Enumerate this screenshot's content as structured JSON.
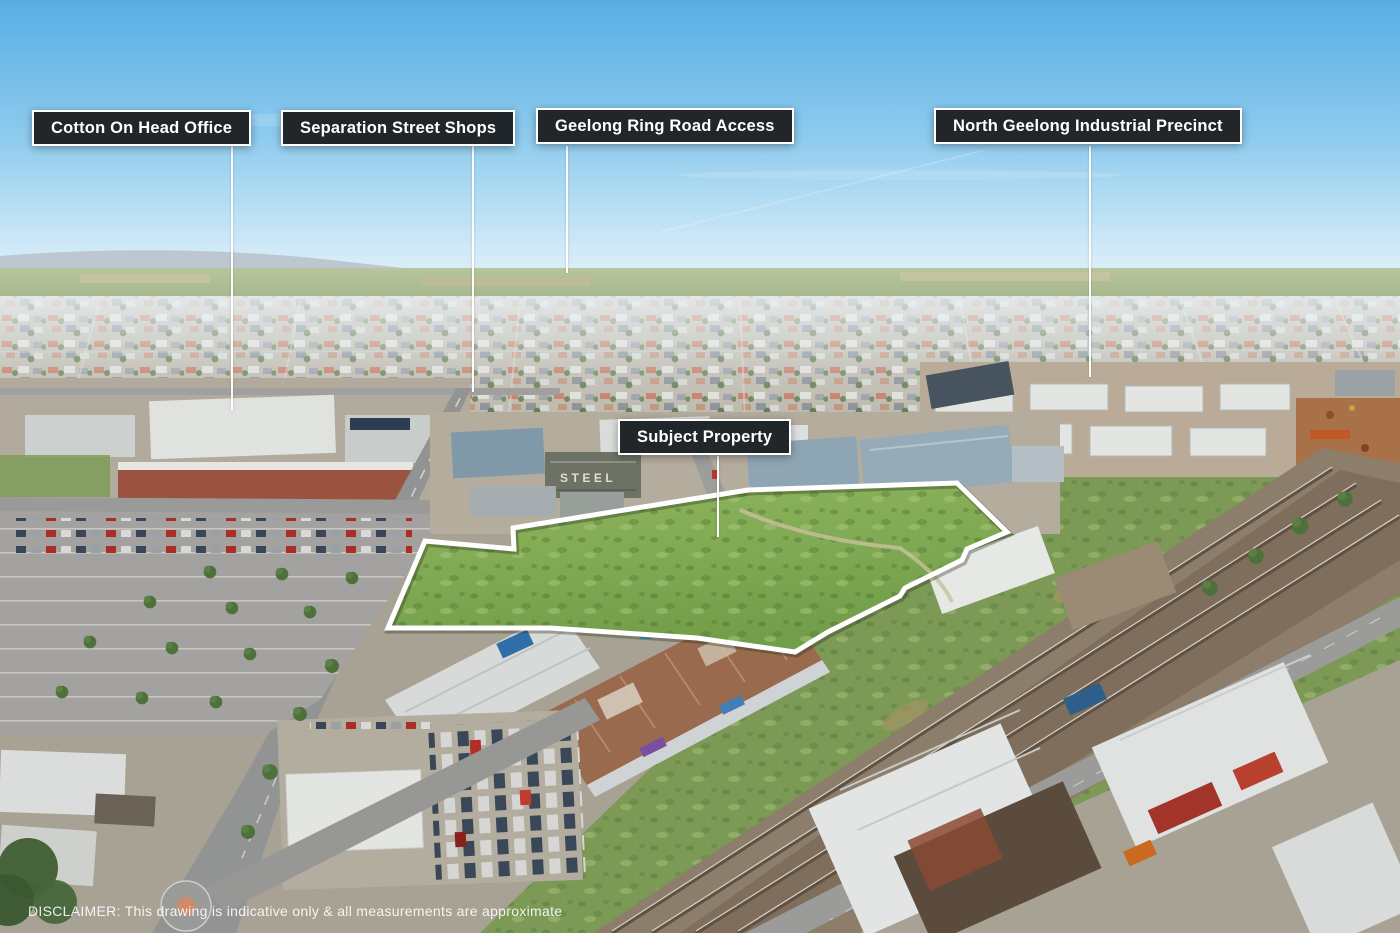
{
  "scene": {
    "description": "Aerial drone photograph of a vacant industrial land parcel outlined in white beside a railway corridor, North Geelong",
    "colors": {
      "sky_top": "#57aee4",
      "sky_horizon": "#eef6fb",
      "field_green": "#7fa952",
      "boundary": "#ffffff",
      "label_background": "#21262a",
      "label_border": "#ffffff",
      "label_text": "#ffffff",
      "railway_ballast": "#8d7d6b",
      "road_grey": "#949695",
      "suburb_base": "#b6b0a2"
    }
  },
  "callouts": [
    {
      "label": "Cotton On Head Office"
    },
    {
      "label": "Separation Street Shops"
    },
    {
      "label": "Geelong Ring Road Access"
    },
    {
      "label": "North Geelong Industrial Precinct"
    }
  ],
  "subject_property": {
    "label": "Subject Property"
  },
  "ground_labels": {
    "steel_roof_sign": "STEEL"
  },
  "disclaimer": "DISCLAIMER: This drawing is indicative only & all measurements are approximate"
}
